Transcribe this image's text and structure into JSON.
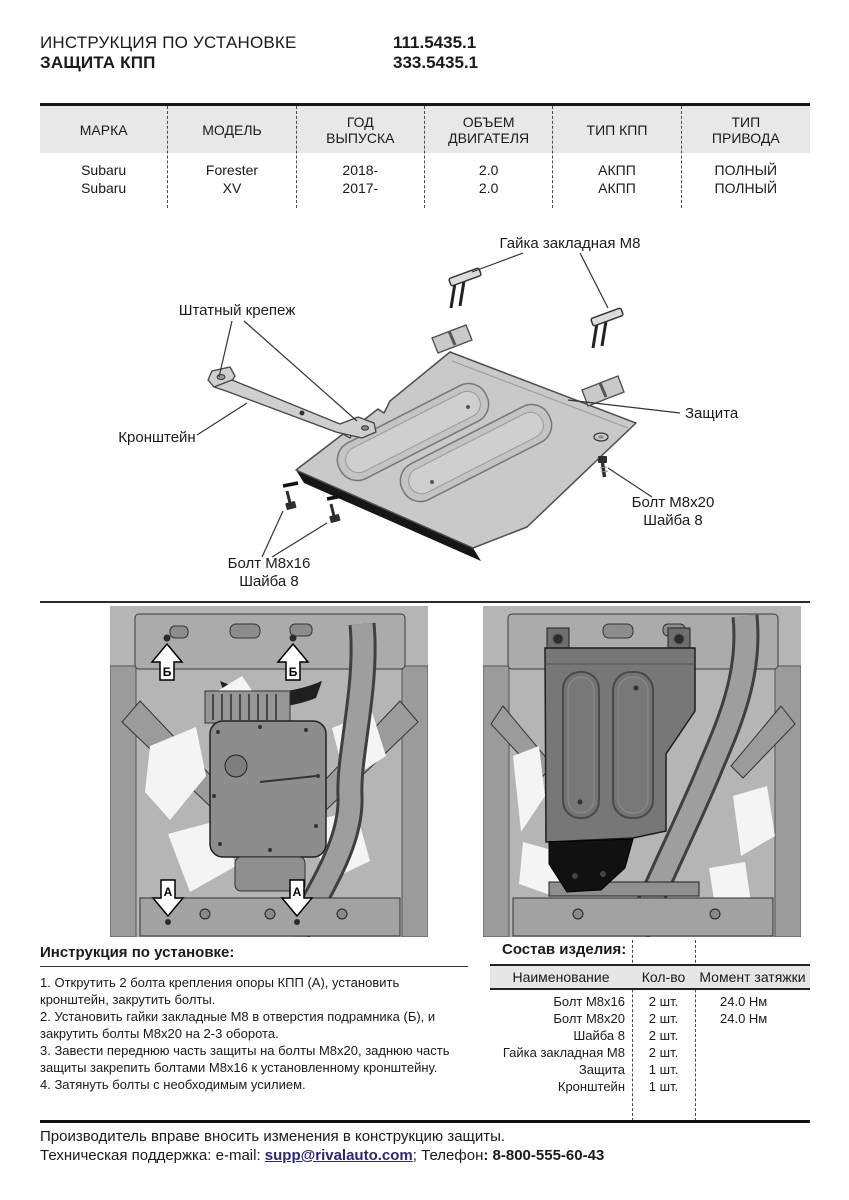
{
  "header": {
    "doc_type": "ИНСТРУКЦИЯ ПО УСТАНОВКЕ",
    "product": "ЗАЩИТА КПП",
    "code1": "111.5435.1",
    "code2": "333.5435.1"
  },
  "vehicle_table": {
    "headers": [
      "МАРКА",
      "МОДЕЛЬ",
      "ГОД\nВЫПУСКА",
      "ОБЪЕМ\nДВИГАТЕЛЯ",
      "ТИП КПП",
      "ТИП\nПРИВОДА"
    ],
    "rows": [
      [
        "Subaru",
        "Forester",
        "2018-",
        "2.0",
        "АКПП",
        "ПОЛНЫЙ"
      ],
      [
        "Subaru",
        "XV",
        "2017-",
        "2.0",
        "АКПП",
        "ПОЛНЫЙ"
      ]
    ]
  },
  "diagram": {
    "labels": {
      "clip_nut": "Гайка закладная М8",
      "factory_fastener": "Штатный крепеж",
      "plate": "Защита",
      "bracket": "Кронштейн",
      "bolt20": "Болт М8х20",
      "washer20": "Шайба 8",
      "bolt16": "Болт М8х16",
      "washer16": "Шайба 8"
    }
  },
  "photos": {
    "marker_top": "Б",
    "marker_bottom": "А"
  },
  "instructions": {
    "title": "Инструкция по установке:",
    "steps": [
      "1. Открутить 2 болта крепления опоры КПП (А), установить кронштейн, закрутить болты.",
      "2. Установить гайки закладные М8 в отверстия подрамника (Б), и закрутить болты М8х20 на 2-3 оборота.",
      "3. Завести переднюю часть защиты на болты М8х20, заднюю часть защиты закрепить болтами М8х16 к установленному кронштейну.",
      "4. Затянуть болты с необходимым усилием."
    ]
  },
  "parts": {
    "title": "Состав изделия:",
    "headers": [
      "Наименование",
      "Кол-во",
      "Момент затяжки"
    ],
    "rows": [
      {
        "name": "Болт М8х16",
        "qty": "2 шт.",
        "torque": "24.0 Нм"
      },
      {
        "name": "Болт М8х20",
        "qty": "2 шт.",
        "torque": "24.0 Нм"
      },
      {
        "name": "Шайба 8",
        "qty": "2 шт.",
        "torque": ""
      },
      {
        "name": "Гайка закладная М8",
        "qty": "2 шт.",
        "torque": ""
      },
      {
        "name": "Защита",
        "qty": "1 шт.",
        "torque": ""
      },
      {
        "name": "Кронштейн",
        "qty": "1 шт.",
        "torque": ""
      }
    ]
  },
  "footer": {
    "line1": "Производитель вправе вносить изменения в конструкцию защиты.",
    "support_prefix": "Техническая поддержка:  e-mail: ",
    "email": "supp@rivalauto.com",
    "after_email": "; ",
    "phone_label": "Телефон",
    "phone": ": 8-800-555-60-43"
  },
  "colors": {
    "link": "#2b2777",
    "table_header_bg": "#e8e8e8",
    "photo_base": "#b5b5b5"
  }
}
